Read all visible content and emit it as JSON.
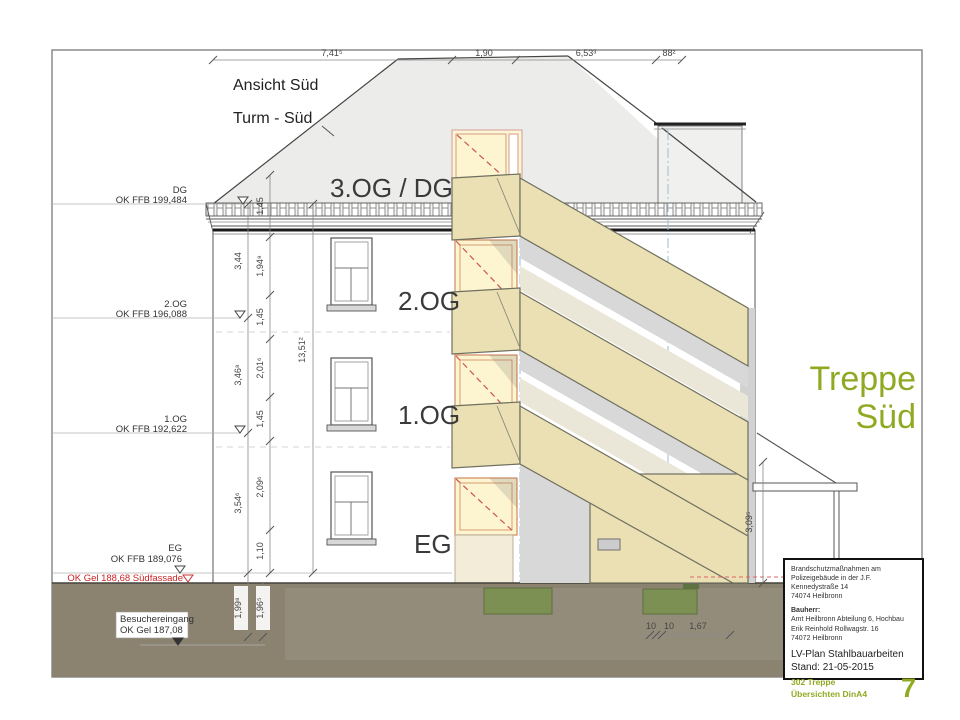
{
  "drawing": {
    "title": "Ansicht Süd",
    "subtitle": "Turm - Süd",
    "side_label_line1": "Treppe",
    "side_label_line2": "Süd",
    "floor_dg": "3.OG / DG",
    "floor_2og": "2.OG",
    "floor_1og": "1.OG",
    "floor_eg": "EG"
  },
  "levels": {
    "dg_name": "DG",
    "dg_value": "OK FFB 199,484",
    "og2_name": "2.OG",
    "og2_value": "OK FFB 196,088",
    "og1_name": "1.OG",
    "og1_value": "OK FFB 192,622",
    "eg_name": "EG",
    "eg_value": "OK FFB 189,076",
    "ground_red": "OK Gel 188,68 Südfassade",
    "visitor_line1": "Besuchereingang",
    "visitor_line2": "OK Gel 187,08"
  },
  "dimensions": {
    "top": [
      "7,41⁵",
      "1,90",
      "6,53³",
      "88²"
    ],
    "chain_outer": [
      "3,44",
      "3,46⁸",
      "3,54⁶",
      "1,99⁸"
    ],
    "chain_inner": [
      "1,45",
      "1,94⁹",
      "1,45",
      "2,01⁶",
      "1,45",
      "2,09⁶",
      "1,10"
    ],
    "total_height": "13,51²",
    "right": "3,09⁵",
    "below_ground_right": "1,96⁵",
    "bottom": [
      "10",
      "10",
      "1,67"
    ]
  },
  "title_block": {
    "project_line1": "Brandschutzmaßnahmen am",
    "project_line2": "Polizeigebäude in der J.F. Kennedystraße 14",
    "project_line3": "74074 Heilbronn",
    "client_label": "Bauherr:",
    "client_line1": "Amt Heilbronn  Abteilung 6, Hochbau",
    "client_line2": "Erik Reinhold    Rollwagstr. 16",
    "client_line3": "74072 Heilbronn",
    "plan_type": "LV-Plan Stahlbauarbeiten",
    "date_line": "Stand:  21-05-2015",
    "plan_no_line1": "302 Treppe",
    "plan_no_line2": "Übersichten DinA4",
    "sheet_number": "7"
  },
  "colors": {
    "accent_olive": "#8faa22",
    "stair_beige": "#ebe0b4",
    "ground_brown": "#8b8370",
    "door_yellow": "#fdf4d0",
    "red_level": "#cc2222"
  }
}
